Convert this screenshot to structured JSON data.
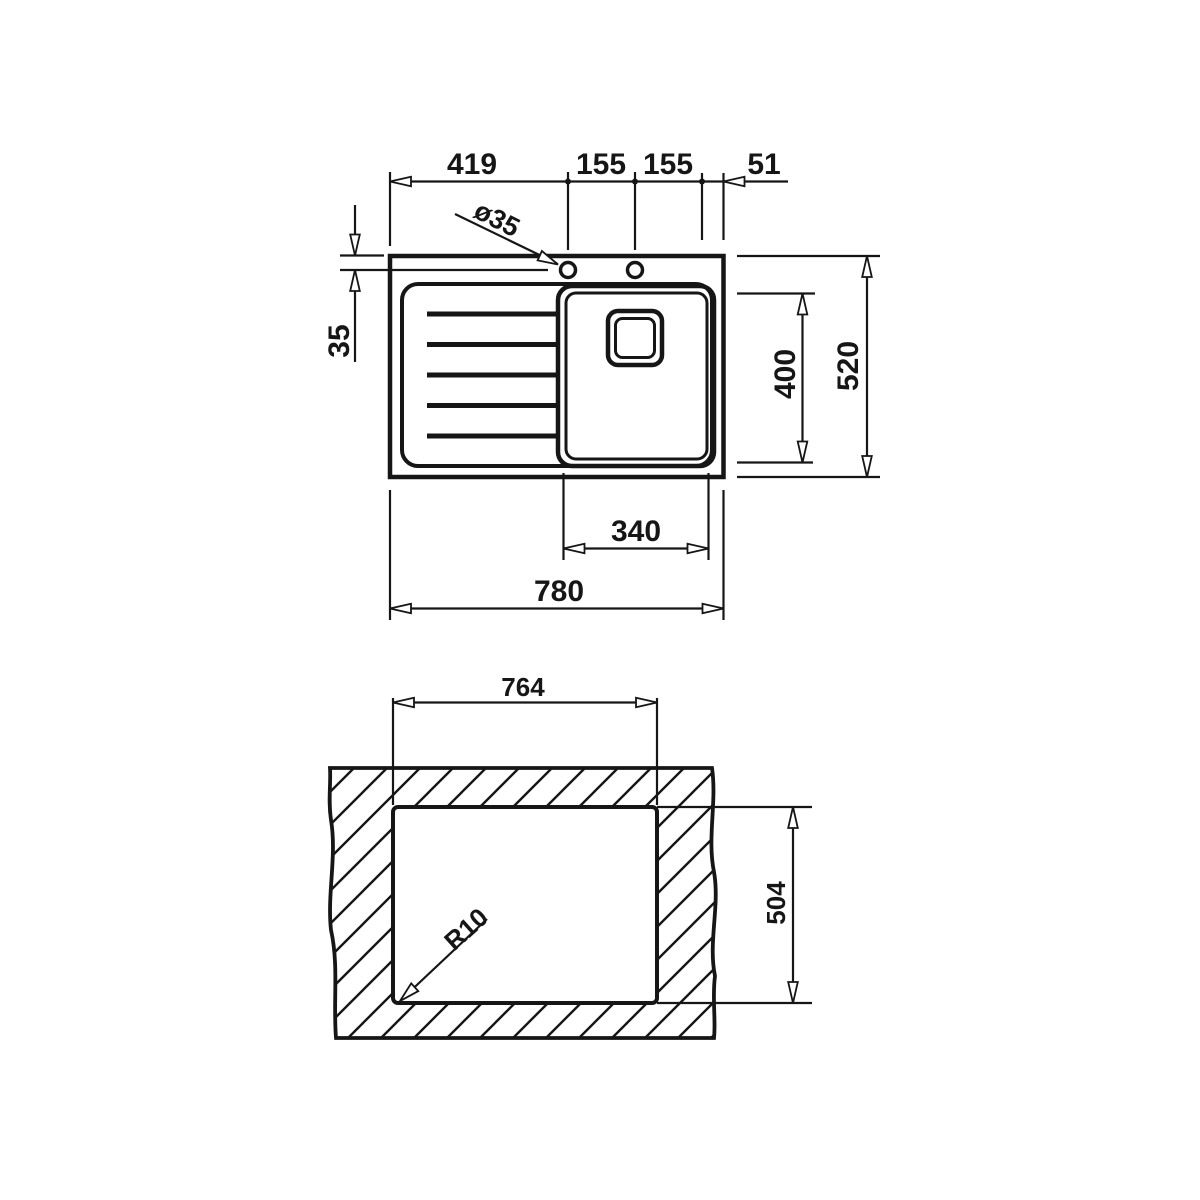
{
  "figure": {
    "type": "technical-drawing",
    "subject": "inset kitchen sink with left drainer: plan view (top) and worktop cut-out view (bottom)",
    "units": "mm",
    "colors": {
      "line": "#161616",
      "background": "#ffffff"
    },
    "plan_view": {
      "dimensions": {
        "drainer_to_hole": "419",
        "hole_pitch_left": "155",
        "hole_pitch_right": "155",
        "edge_offset": "51",
        "hole_diameter": "ø35",
        "hole_setback": "35",
        "bowl_width": "340",
        "bowl_length": "400",
        "overall_depth": "520",
        "overall_width": "780"
      }
    },
    "cutout_view": {
      "dimensions": {
        "cutout_width": "764",
        "cutout_depth": "504",
        "corner_radius": "R10"
      }
    }
  }
}
